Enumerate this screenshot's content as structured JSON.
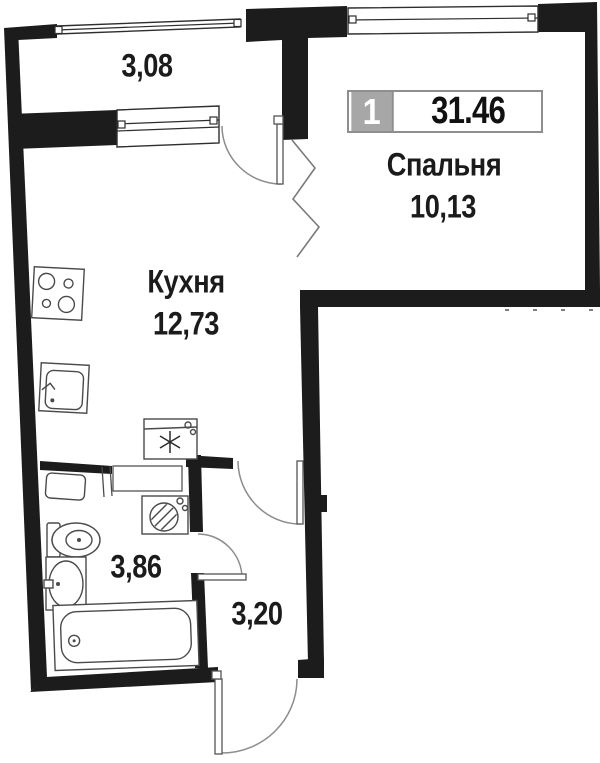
{
  "badge": {
    "room_count": "1",
    "total_area": "31.46"
  },
  "rooms": {
    "balcony": {
      "area": "3,08"
    },
    "bedroom": {
      "name": "Спальня",
      "area": "10,13"
    },
    "kitchen": {
      "name": "Кухня",
      "area": "12,73"
    },
    "bathroom": {
      "area": "3,86"
    },
    "hall": {
      "area": "3,20"
    }
  },
  "colors": {
    "wall": "#1c1c1c",
    "fixture_line": "#4a4a4a",
    "door_arc": "#8c8c8c",
    "text": "#1b1b1b",
    "badge_gray": "#a7a7a7",
    "badge_border": "#8e8e8e"
  }
}
